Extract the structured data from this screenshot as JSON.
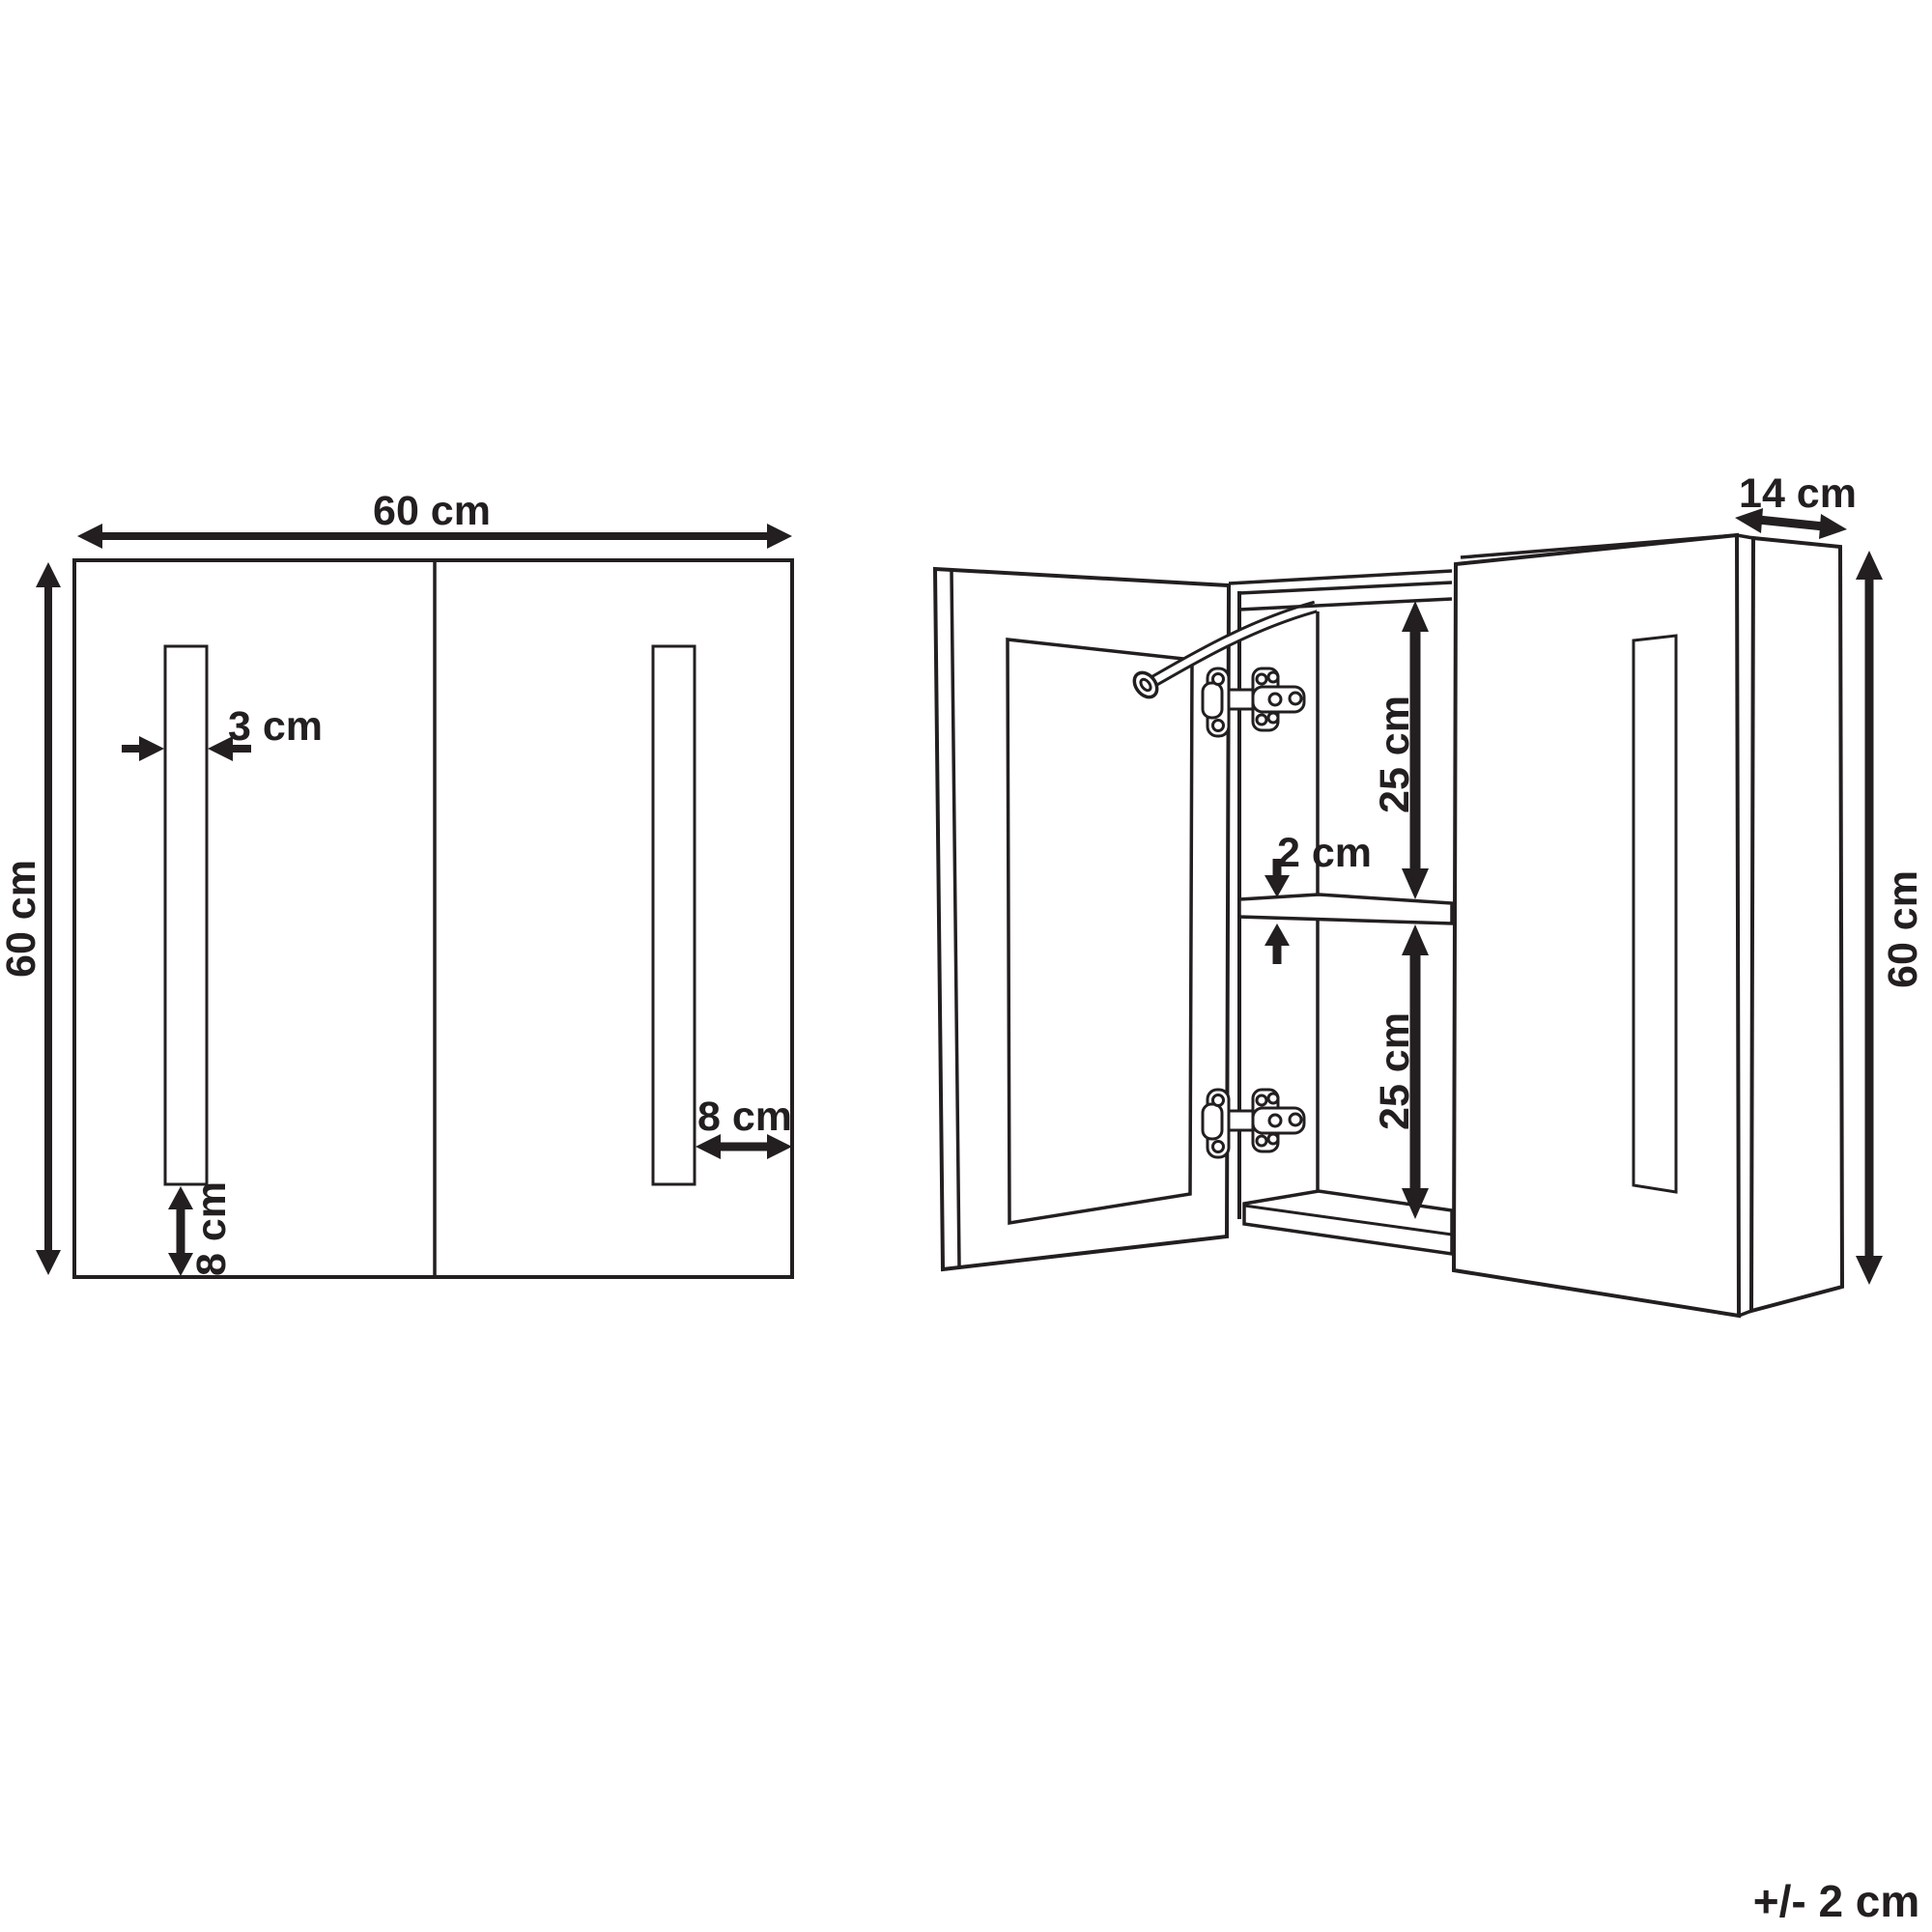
{
  "page": {
    "background": "#ffffff",
    "ink": "#231f20"
  },
  "front_view": {
    "width": "60 cm",
    "height": "60 cm",
    "strip_width": "3 cm",
    "strip_bottom_gap": "8 cm",
    "strip_edge_gap": "8 cm"
  },
  "open_view": {
    "depth": "14 cm",
    "height": "60 cm",
    "upper_shelf_space": "25 cm",
    "shelf_thickness": "2 cm",
    "lower_shelf_space": "25 cm"
  },
  "tolerance": "+/- 2 cm"
}
